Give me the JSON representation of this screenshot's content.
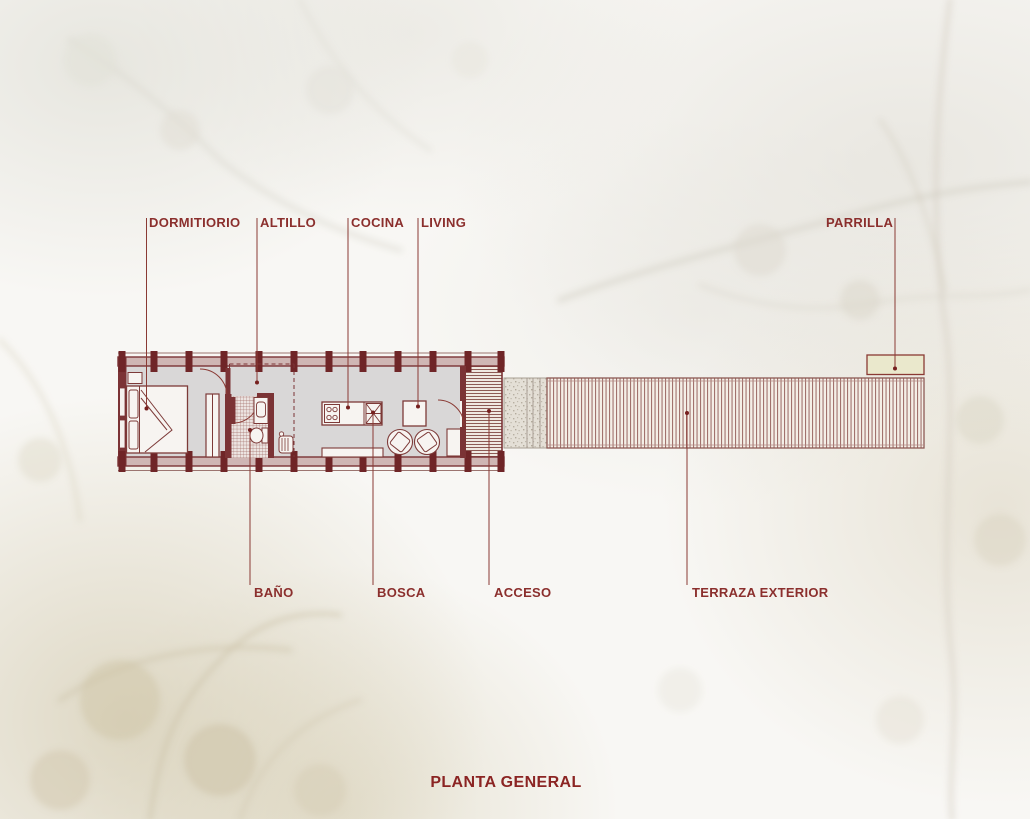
{
  "title": "PLANTA GENERAL",
  "plan": {
    "top_labels": [
      {
        "id": "dormitorio",
        "text": "DORMITIORIO"
      },
      {
        "id": "altillo",
        "text": "ALTILLO"
      },
      {
        "id": "cocina",
        "text": "COCINA"
      },
      {
        "id": "living",
        "text": "LIVING"
      },
      {
        "id": "parrilla",
        "text": "PARRILLA"
      }
    ],
    "bottom_labels": [
      {
        "id": "bano",
        "text": "BAÑO"
      },
      {
        "id": "bosca",
        "text": "BOSCA"
      },
      {
        "id": "acceso",
        "text": "ACCESO"
      },
      {
        "id": "terraza",
        "text": "TERRAZA EXTERIOR"
      }
    ],
    "symbols": [
      "bed-icon",
      "wardrobe-icon",
      "door-swing-icon",
      "shower-tiles-icon",
      "toilet-icon",
      "sink-icon",
      "heater-icon",
      "stove-icon",
      "kitchen-island-icon",
      "wood-stove-icon",
      "table-icon",
      "chair-icon",
      "bench-icon",
      "deck-planks-icon",
      "gravel-path-icon",
      "grill-icon",
      "column-icon",
      "loft-dashed-outline-icon"
    ]
  },
  "colors": {
    "accent_text": "#8b2f2d",
    "wall": "#7b3335",
    "column": "#6f2527",
    "wall_fill": "#cfb6b4",
    "floor": "#d9d7d7",
    "deck_line": "#a1726d",
    "parrilla_fill": "#eae8cc",
    "background": "#f8f7f4"
  }
}
